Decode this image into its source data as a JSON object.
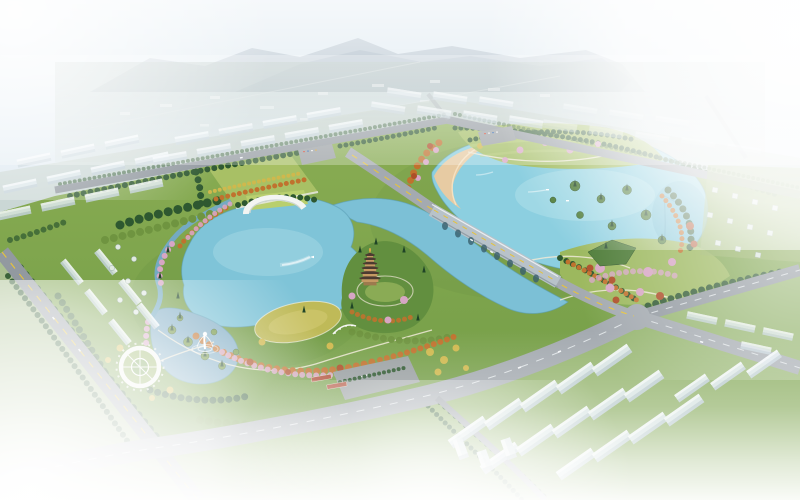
{
  "image": {
    "type": "architectural aerial perspective rendering",
    "subject": "Lakeside park master plan: twin lakes with arched road bridge, pagoda hill, circular plaza, fountain lagoon, crescent beach, flowering tree bands, and surrounding white city blocks fading into haze",
    "landmarks": [
      "pagoda",
      "arched-bridge",
      "circular-plaza",
      "fountain",
      "beach",
      "left-lake",
      "right-lake",
      "lagoon",
      "city-blocks"
    ]
  },
  "palette": {
    "sky": "#dce8f0",
    "mountain": "#8799aa",
    "distant": "#a7bbb1",
    "park": "#7ba34d",
    "lawn": "#a8c065",
    "lawn_yellow": "#bfba58",
    "meadow": "#9cb85e",
    "hill_lawn": "#a3bd62",
    "lake_left": "#7fc4d8",
    "lake_right": "#8ccfe0",
    "strait": "#7cc0d6",
    "lagoon": "#82aec6",
    "stream": "#74aac2",
    "beach": "#ecca9f",
    "road": "#9299a0",
    "road_major": "#a4aab0",
    "road_line": "#e6c33c",
    "bridge": "#b8c2c9",
    "building": "#e7eef3",
    "tree_dark": "#2e5830",
    "tree_orange": "#c0722e",
    "tree_pink": "#d7a6c4",
    "tree_yellow": "#cfb84d",
    "tree_red": "#ad4e28",
    "plaza": "#f2f4ef",
    "pagoda_roof": "#4c3b31",
    "pagoda_body": "#c59a63",
    "fog": "#ffffff"
  }
}
